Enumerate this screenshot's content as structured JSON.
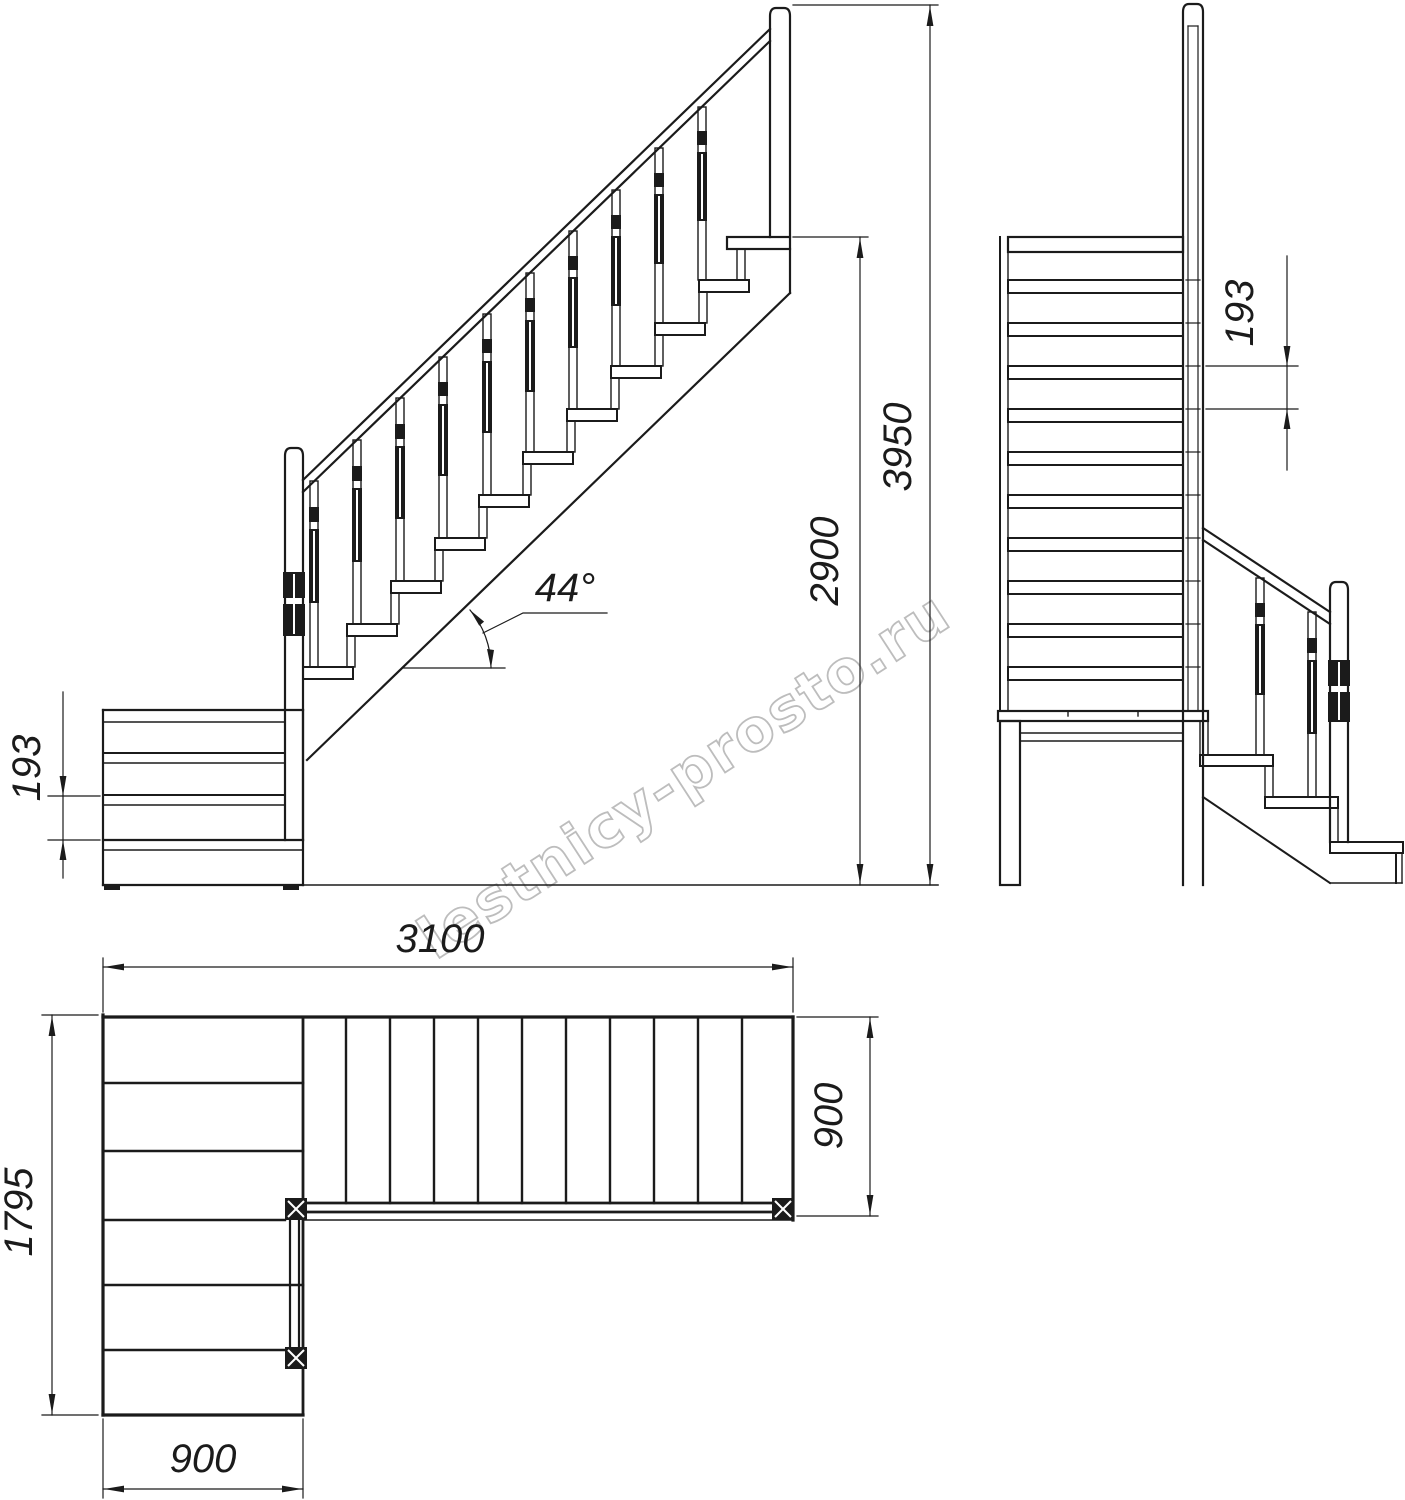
{
  "drawing": {
    "type": "staircase-technical-drawing",
    "line_color": "#1b1b1b",
    "background": "#ffffff"
  },
  "watermark": {
    "text": "lestnicy-prosto.ru",
    "color": "#bdbdbd"
  },
  "views": {
    "side_elevation": {
      "riser_height": "193",
      "slope_angle": "44°",
      "landing_height": "2900",
      "total_height": "3950"
    },
    "front_elevation": {
      "riser_height": "193"
    },
    "plan": {
      "upper_flight_run": "3100",
      "upper_flight_width": "900",
      "overall_depth": "1795",
      "lower_flight_width": "900"
    }
  }
}
